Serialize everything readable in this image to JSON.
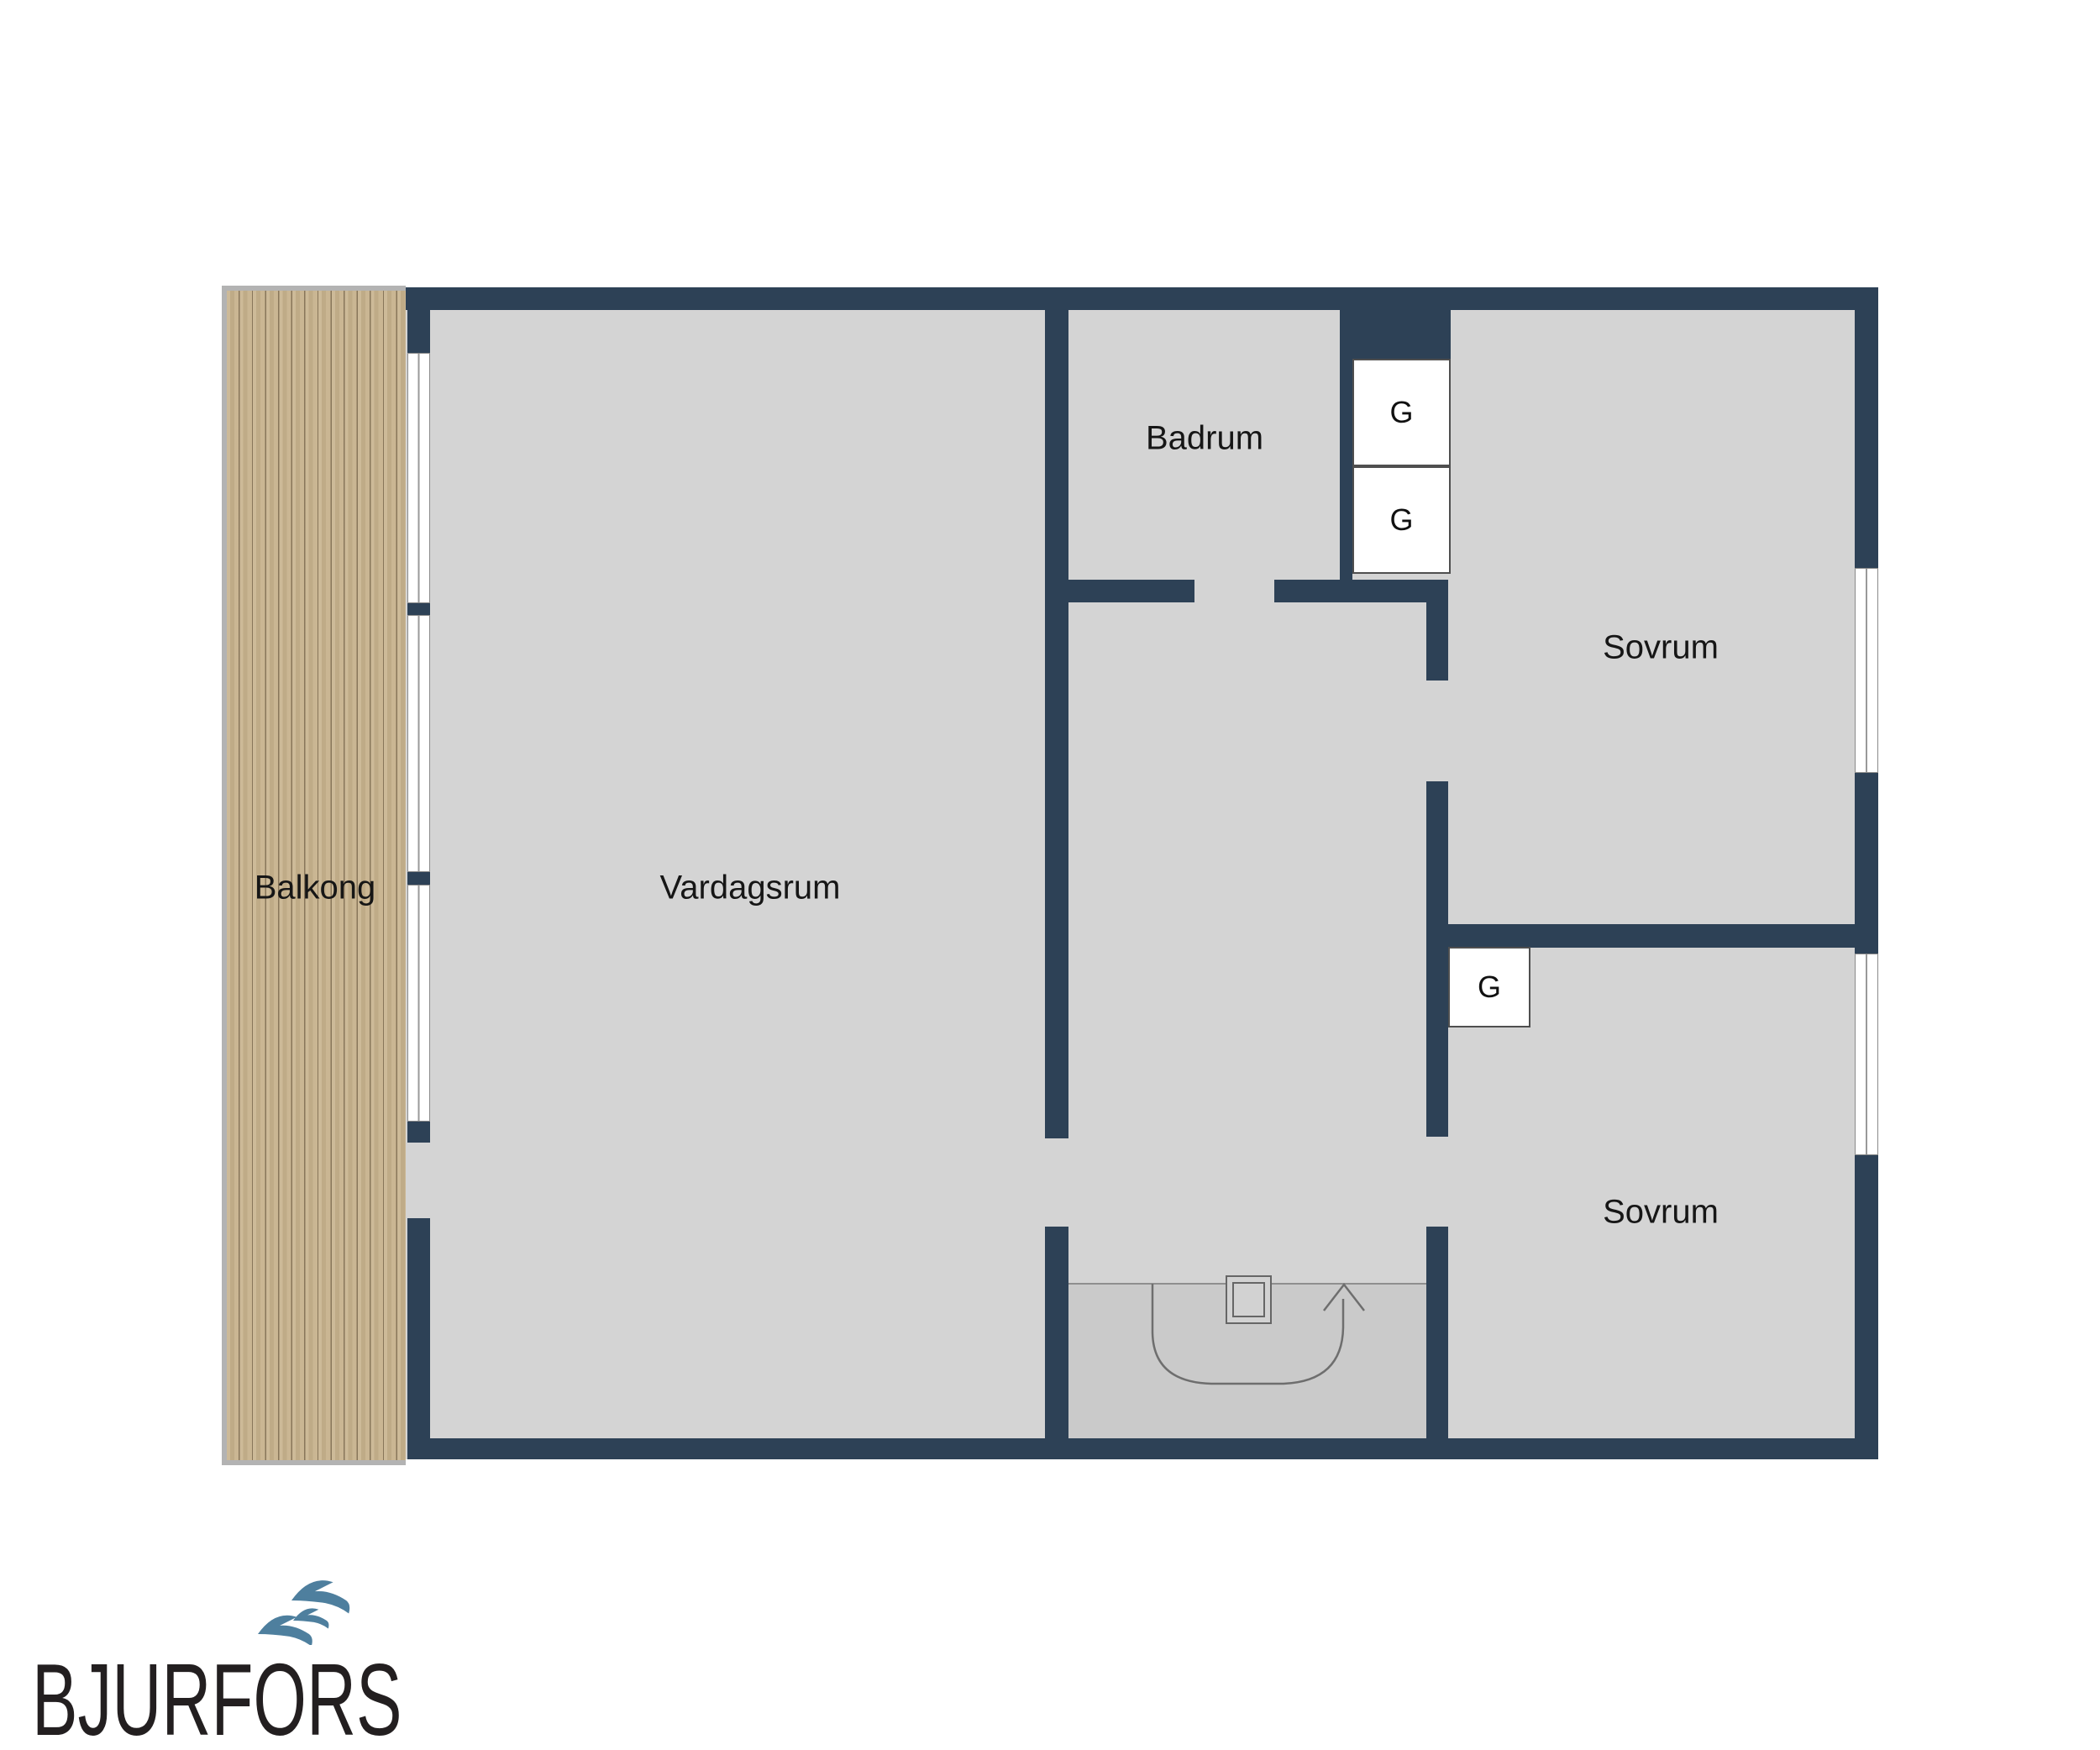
{
  "plan": {
    "rooms": [
      {
        "id": "balcony",
        "label": "Balkong"
      },
      {
        "id": "living",
        "label": "Vardagsrum"
      },
      {
        "id": "bathroom",
        "label": "Badrum"
      },
      {
        "id": "bedroom-1",
        "label": "Sovrum"
      },
      {
        "id": "bedroom-2",
        "label": "Sovrum"
      }
    ],
    "closets": [
      {
        "id": "closet-1",
        "label": "G"
      },
      {
        "id": "closet-2",
        "label": "G"
      },
      {
        "id": "closet-3",
        "label": "G"
      }
    ]
  },
  "logo": {
    "text": "BJURFORS"
  },
  "colors": {
    "wall": "#2d4156",
    "floor": "#d4d4d4",
    "floor-entry": "#cacaca",
    "wood": "#c7b28c",
    "bird": "#4e7f9e",
    "logo-text": "#231f20"
  }
}
